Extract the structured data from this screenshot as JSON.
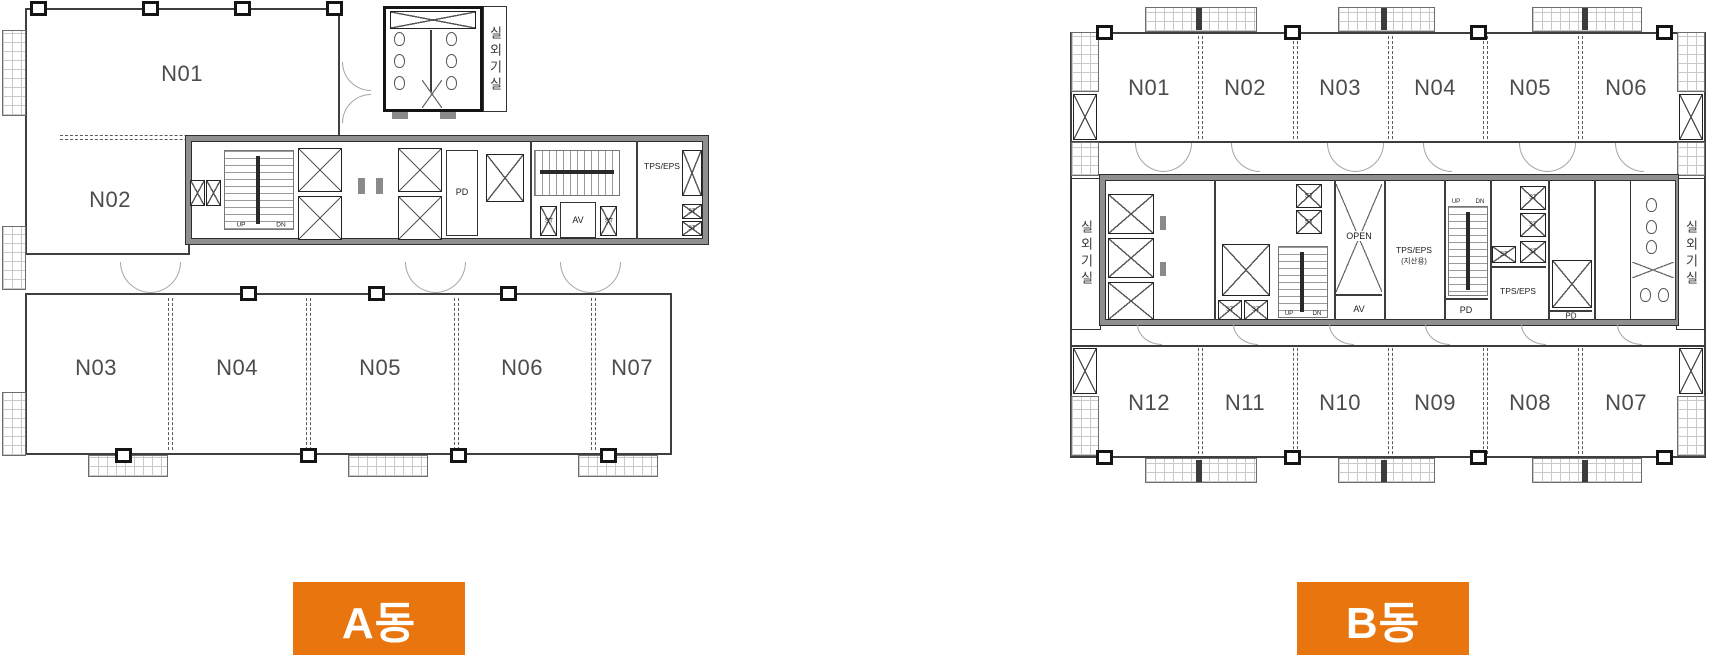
{
  "colors": {
    "badge_orange": "#e8750e"
  },
  "labels": {
    "up": "UP",
    "dn": "DN",
    "st": "ST",
    "pd": "PD",
    "av": "AV",
    "open": "OPEN",
    "tps_eps": "TPS/EPS",
    "tps_eps_note": "(지산용)",
    "outdoor_room": "실외기실"
  },
  "plans": {
    "a": {
      "badge": "A동",
      "units_upper": [
        "N01",
        "N02"
      ],
      "units_lower": [
        "N03",
        "N04",
        "N05",
        "N06",
        "N07"
      ]
    },
    "b": {
      "badge": "B동",
      "units_top": [
        "N01",
        "N02",
        "N03",
        "N04",
        "N05",
        "N06"
      ],
      "units_bottom": [
        "N12",
        "N11",
        "N10",
        "N09",
        "N08",
        "N07"
      ]
    }
  }
}
